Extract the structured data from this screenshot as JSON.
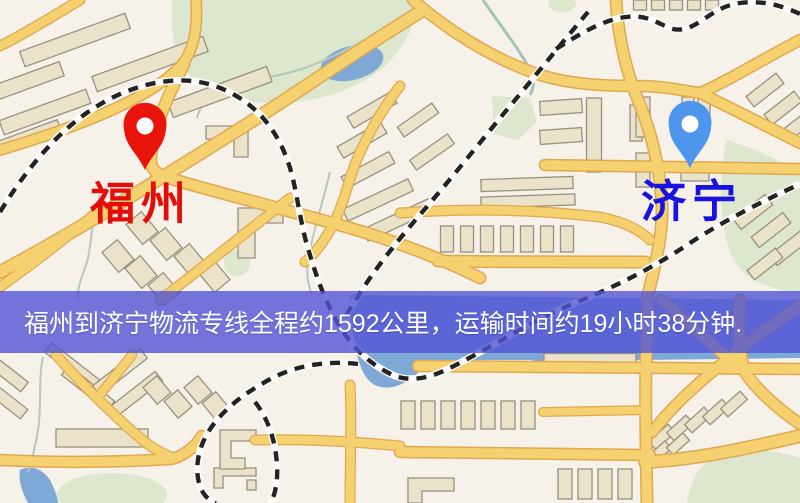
{
  "banner": {
    "text": "福州到济宁物流专线全程约1592公里，运输时间约19小时38分钟.",
    "background": "#5254d4",
    "background_opacity": 0.8,
    "text_color": "#ffffff"
  },
  "route": {
    "origin": "福州",
    "destination": "济宁",
    "distance_km": "1592",
    "duration_hours": "19",
    "duration_minutes": "38"
  },
  "markers": {
    "origin": {
      "label": "福州",
      "label_color": "#e50d08",
      "pin_color": "#e9140b",
      "pin": "red-pin"
    },
    "destination": {
      "label": "济宁",
      "label_color": "#1813e0",
      "pin_color": "#4e95ec",
      "pin": "blue-pin"
    }
  },
  "map_colors": {
    "background": "#f6f1e9",
    "road_fill": "#f5d170",
    "road_casing": "#e0a853",
    "railway": "#232323",
    "water": "#7ea9d6",
    "park": "#dce7cd",
    "building": "#ebe3c9"
  }
}
